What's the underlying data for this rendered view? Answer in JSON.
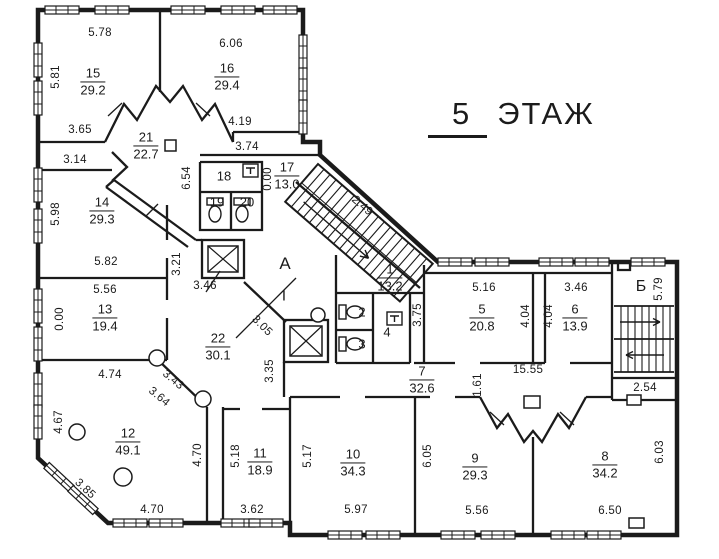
{
  "colors": {
    "ink": "#1b1b1b",
    "paper": "#ffffff"
  },
  "title": {
    "number": "5",
    "word": "ЭТАЖ"
  },
  "rooms": [
    {
      "number": "15",
      "area": "29.2",
      "x": 93,
      "y": 82
    },
    {
      "number": "16",
      "area": "29.4",
      "x": 227,
      "y": 77
    },
    {
      "number": "21",
      "area": "22.7",
      "x": 146,
      "y": 146
    },
    {
      "number": "17",
      "area": "13.0",
      "x": 287,
      "y": 176
    },
    {
      "number": "14",
      "area": "29.3",
      "x": 102,
      "y": 211
    },
    {
      "number": "13",
      "area": "19.4",
      "x": 105,
      "y": 318
    },
    {
      "number": "22",
      "area": "30.1",
      "x": 218,
      "y": 347
    },
    {
      "number": "12",
      "area": "49.1",
      "x": 128,
      "y": 442
    },
    {
      "number": "11",
      "area": "18.9",
      "x": 260,
      "y": 462
    },
    {
      "number": "10",
      "area": "34.3",
      "x": 353,
      "y": 463
    },
    {
      "number": "9",
      "area": "29.3",
      "x": 475,
      "y": 467
    },
    {
      "number": "8",
      "area": "34.2",
      "x": 605,
      "y": 465
    },
    {
      "number": "7",
      "area": "32.6",
      "x": 422,
      "y": 380
    },
    {
      "number": "1",
      "area": "13.2",
      "x": 390,
      "y": 278
    },
    {
      "number": "5",
      "area": "20.8",
      "x": 482,
      "y": 318
    },
    {
      "number": "6",
      "area": "13.9",
      "x": 575,
      "y": 318
    }
  ],
  "labels": [
    {
      "text": "18",
      "x": 224,
      "y": 176,
      "size": 13
    },
    {
      "text": "19",
      "x": 217,
      "y": 202,
      "size": 13
    },
    {
      "text": "20",
      "x": 247,
      "y": 202,
      "size": 13
    },
    {
      "text": "2",
      "x": 362,
      "y": 312,
      "size": 13
    },
    {
      "text": "3",
      "x": 362,
      "y": 344,
      "size": 13
    },
    {
      "text": "4",
      "x": 387,
      "y": 332,
      "size": 13
    },
    {
      "text": "A",
      "x": 285,
      "y": 264,
      "size": 17
    },
    {
      "text": "I",
      "x": 284,
      "y": 296,
      "size": 15
    },
    {
      "text": "Б",
      "x": 641,
      "y": 287,
      "size": 16
    }
  ],
  "dimensions": [
    {
      "text": "5.78",
      "x": 100,
      "y": 33,
      "rot": 0
    },
    {
      "text": "6.06",
      "x": 231,
      "y": 44,
      "rot": 0
    },
    {
      "text": "5.81",
      "x": 56,
      "y": 77,
      "rot": -90
    },
    {
      "text": "3.65",
      "x": 80,
      "y": 130,
      "rot": 0
    },
    {
      "text": "4.19",
      "x": 240,
      "y": 122,
      "rot": 0
    },
    {
      "text": "3.74",
      "x": 247,
      "y": 147,
      "rot": 0
    },
    {
      "text": "3.14",
      "x": 75,
      "y": 160,
      "rot": 0
    },
    {
      "text": "6.54",
      "x": 187,
      "y": 178,
      "rot": -90
    },
    {
      "text": "0.00",
      "x": 268,
      "y": 179,
      "rot": -90
    },
    {
      "text": "2.49",
      "x": 362,
      "y": 206,
      "rot": 41
    },
    {
      "text": "5.98",
      "x": 56,
      "y": 214,
      "rot": -90
    },
    {
      "text": "5.82",
      "x": 106,
      "y": 262,
      "rot": 0
    },
    {
      "text": "3.21",
      "x": 177,
      "y": 264,
      "rot": -90
    },
    {
      "text": "5.56",
      "x": 105,
      "y": 290,
      "rot": 0
    },
    {
      "text": "3.46",
      "x": 205,
      "y": 286,
      "rot": 0
    },
    {
      "text": "0.00",
      "x": 60,
      "y": 319,
      "rot": -90
    },
    {
      "text": "3.05",
      "x": 262,
      "y": 326,
      "rot": 45
    },
    {
      "text": "3.35",
      "x": 270,
      "y": 371,
      "rot": -90
    },
    {
      "text": "4.74",
      "x": 110,
      "y": 375,
      "rot": 0
    },
    {
      "text": "3.43",
      "x": 173,
      "y": 380,
      "rot": 40
    },
    {
      "text": "3.64",
      "x": 159,
      "y": 397,
      "rot": 40
    },
    {
      "text": "4.67",
      "x": 59,
      "y": 422,
      "rot": -90
    },
    {
      "text": "3.85",
      "x": 85,
      "y": 489,
      "rot": 43
    },
    {
      "text": "4.70",
      "x": 152,
      "y": 510,
      "rot": 0
    },
    {
      "text": "4.70",
      "x": 198,
      "y": 455,
      "rot": -90
    },
    {
      "text": "5.18",
      "x": 236,
      "y": 456,
      "rot": -90
    },
    {
      "text": "3.62",
      "x": 252,
      "y": 510,
      "rot": 0
    },
    {
      "text": "5.17",
      "x": 308,
      "y": 456,
      "rot": -90
    },
    {
      "text": "5.97",
      "x": 356,
      "y": 510,
      "rot": 0
    },
    {
      "text": "6.05",
      "x": 428,
      "y": 456,
      "rot": -90
    },
    {
      "text": "5.56",
      "x": 477,
      "y": 511,
      "rot": 0
    },
    {
      "text": "6.50",
      "x": 610,
      "y": 511,
      "rot": 0
    },
    {
      "text": "6.03",
      "x": 660,
      "y": 452,
      "rot": -90
    },
    {
      "text": "2.54",
      "x": 645,
      "y": 388,
      "rot": 0
    },
    {
      "text": "1.61",
      "x": 478,
      "y": 385,
      "rot": -90
    },
    {
      "text": "15.55",
      "x": 528,
      "y": 370,
      "rot": 0
    },
    {
      "text": "3.75",
      "x": 418,
      "y": 315,
      "rot": -90
    },
    {
      "text": "5.16",
      "x": 484,
      "y": 288,
      "rot": 0
    },
    {
      "text": "4.04",
      "x": 526,
      "y": 316,
      "rot": -90
    },
    {
      "text": "4.04",
      "x": 549,
      "y": 316,
      "rot": -90
    },
    {
      "text": "3.46",
      "x": 576,
      "y": 288,
      "rot": 0
    },
    {
      "text": "5.79",
      "x": 659,
      "y": 289,
      "rot": -90
    }
  ]
}
